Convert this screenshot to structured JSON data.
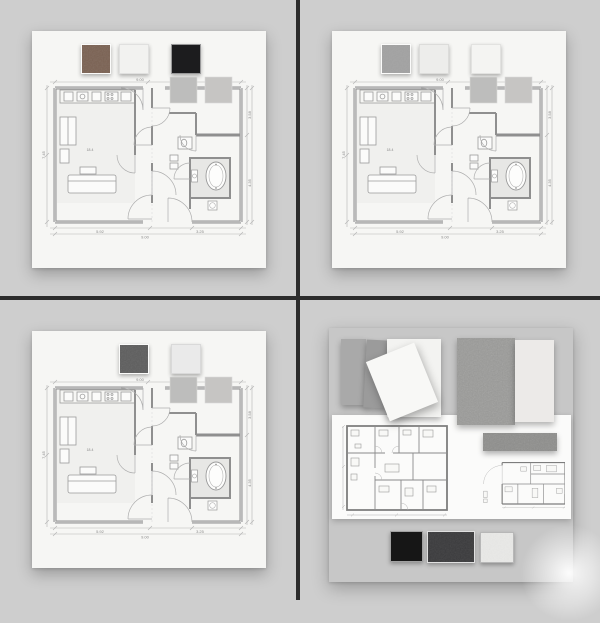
{
  "page": {
    "background": "#cecece",
    "divider_color": "#2c2c2c"
  },
  "floor_plan": {
    "dims": {
      "top": "9.00",
      "left": "7.45",
      "right_upper": "3.58",
      "right_lower": "4.35",
      "bottom_left": "5.92",
      "bottom_right": "3.25",
      "bottom_total": "9.00"
    },
    "rooms": {
      "living_area": "18.4",
      "bath_area": "4.6"
    },
    "plan_swatches": [
      {
        "name": "light-gray-tile",
        "color": "#bdbdbc"
      },
      {
        "name": "warm-gray-tile",
        "color": "#c6c5c3"
      }
    ]
  },
  "top_left": {
    "board_color": "#f6f6f4",
    "swatches": [
      {
        "name": "brown-leather",
        "color": "#7a6152"
      },
      {
        "name": "white-matte",
        "color": "#f2f2f0"
      },
      {
        "name": "black-matte",
        "color": "#1c1c1e"
      }
    ]
  },
  "top_right": {
    "board_color": "#f6f6f4",
    "swatches": [
      {
        "name": "gray-textile",
        "color": "#a2a2a2"
      },
      {
        "name": "light-gray-matte",
        "color": "#ededeb"
      },
      {
        "name": "white-matte",
        "color": "#f4f4f2"
      }
    ]
  },
  "bottom_left": {
    "board_color": "#f6f6f4",
    "swatches": [
      {
        "name": "charcoal-textile",
        "color": "#5d5d5d"
      },
      {
        "name": "off-white-matte",
        "color": "#eaeaea"
      }
    ]
  },
  "bottom_right": {
    "board_color": "#c7c7c7",
    "sheet_color": "#fbfbfa",
    "panels": [
      {
        "name": "gray-panel",
        "color": "#a9a9a9"
      },
      {
        "name": "slate-gray-panel",
        "color": "#9b9b9b"
      },
      {
        "name": "white-card",
        "color": "#f3f3f1"
      },
      {
        "name": "white-card-tilted",
        "color": "#f8f8f6"
      },
      {
        "name": "concrete-panel",
        "color": "#9a9a98"
      },
      {
        "name": "plaster-panel",
        "color": "#eceae8"
      },
      {
        "name": "concrete-strip",
        "color": "#8d8d8b"
      }
    ],
    "bottom_swatches": [
      {
        "name": "black-laminate",
        "color": "#161616"
      },
      {
        "name": "charcoal-laminate",
        "color": "#3a3a3c"
      },
      {
        "name": "speckled-white-laminate",
        "color": "#e9e9e7"
      }
    ]
  }
}
